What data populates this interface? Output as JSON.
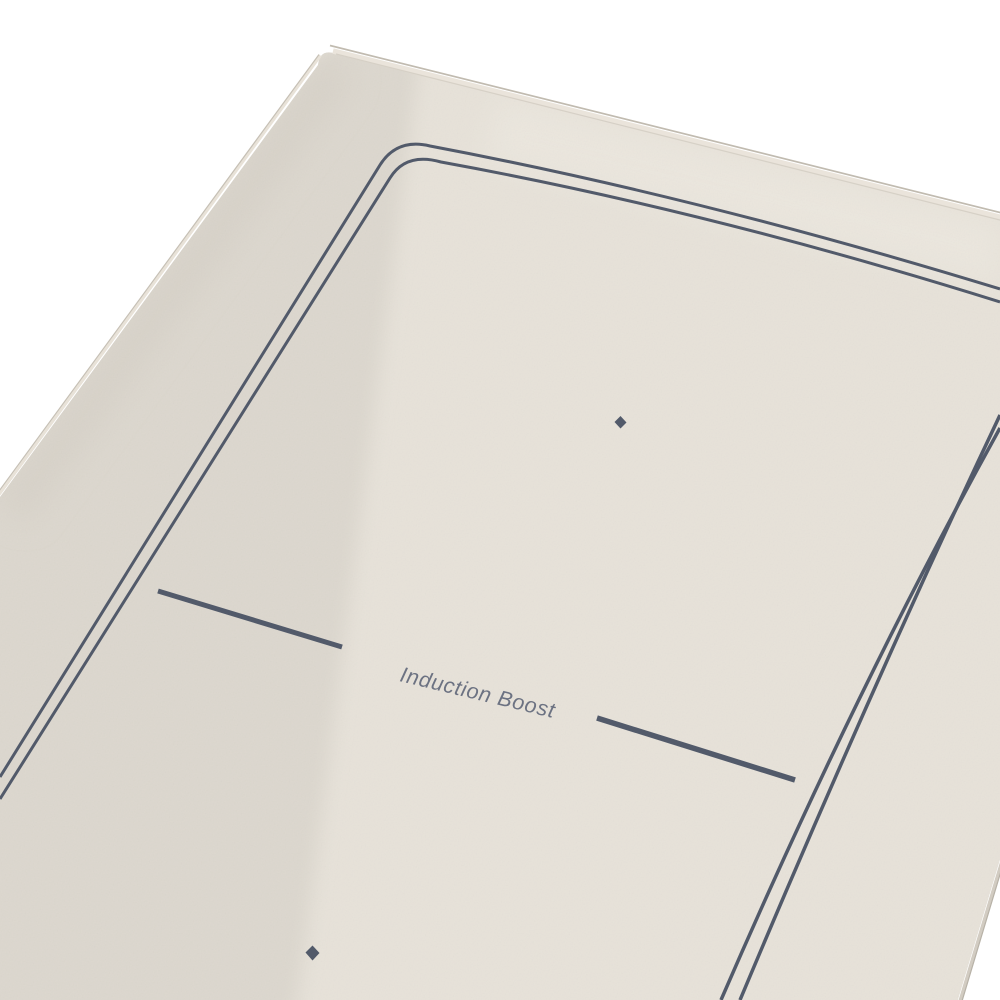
{
  "scene": {
    "name": "induction-cooktop-panel-product-shot"
  },
  "cooktop": {
    "label": "Induction Boost",
    "colors": {
      "background": "#ffffff",
      "surface": "#e7e2d9",
      "surface_shade": "#dcd7ce",
      "line": "#525a6a",
      "text": "#6c7282"
    }
  }
}
